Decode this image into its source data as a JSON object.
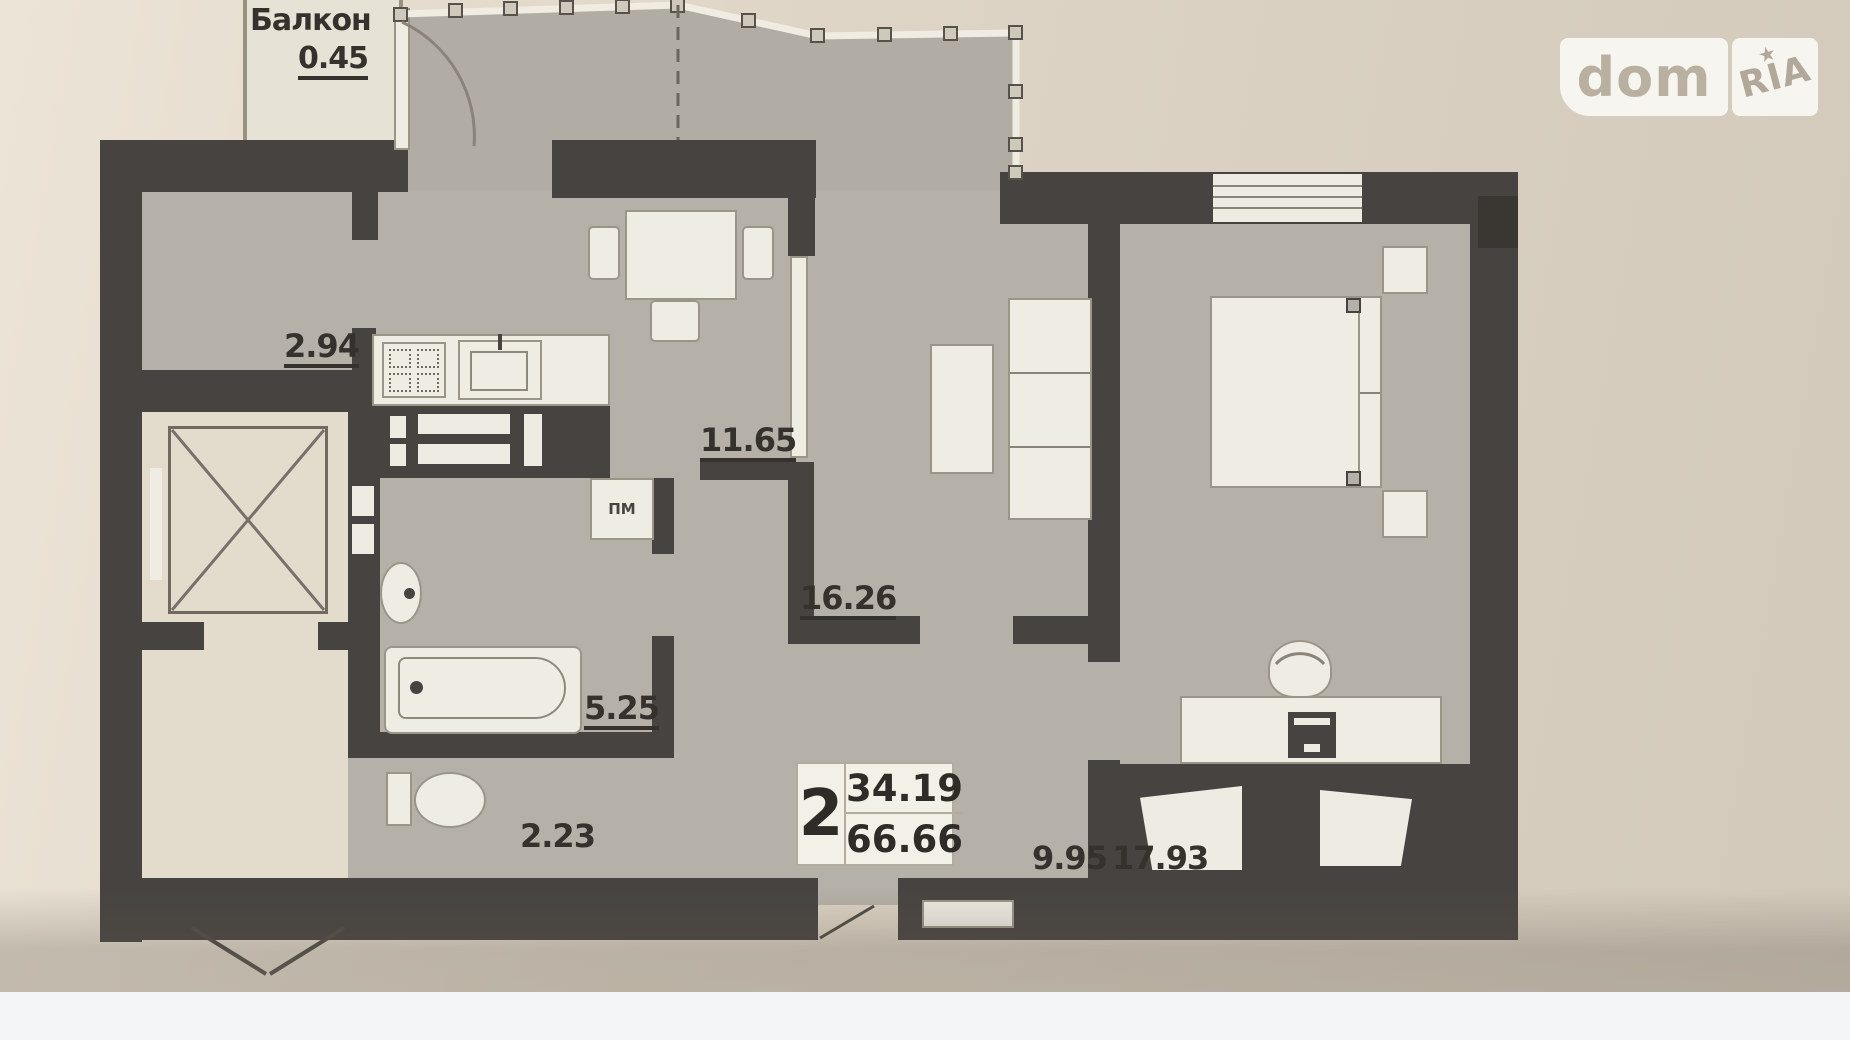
{
  "watermark": {
    "left": "dom",
    "right": "RIA",
    "star": "★"
  },
  "plan": {
    "balcony": {
      "label": "Балкон",
      "area": "0.45"
    },
    "rooms": {
      "hall": {
        "area": "2.94"
      },
      "kitchen": {
        "area": "11.65"
      },
      "living": {
        "area": "16.26"
      },
      "bathroom": {
        "area": "5.25"
      },
      "wc": {
        "area": "2.23"
      },
      "corridor": {
        "area": "9.95"
      },
      "bedroom": {
        "area": "17.93"
      }
    },
    "appliances": {
      "washing_machine": "ПМ"
    },
    "summary": {
      "rooms_count": "2",
      "living_area": "34.19",
      "total_area": "66.66"
    }
  },
  "colors": {
    "wall": "#474340",
    "floor": "#b5b1a8",
    "background": "#ddd4c5",
    "furniture": "#efece3",
    "page_strip": "#f4f5f6"
  }
}
